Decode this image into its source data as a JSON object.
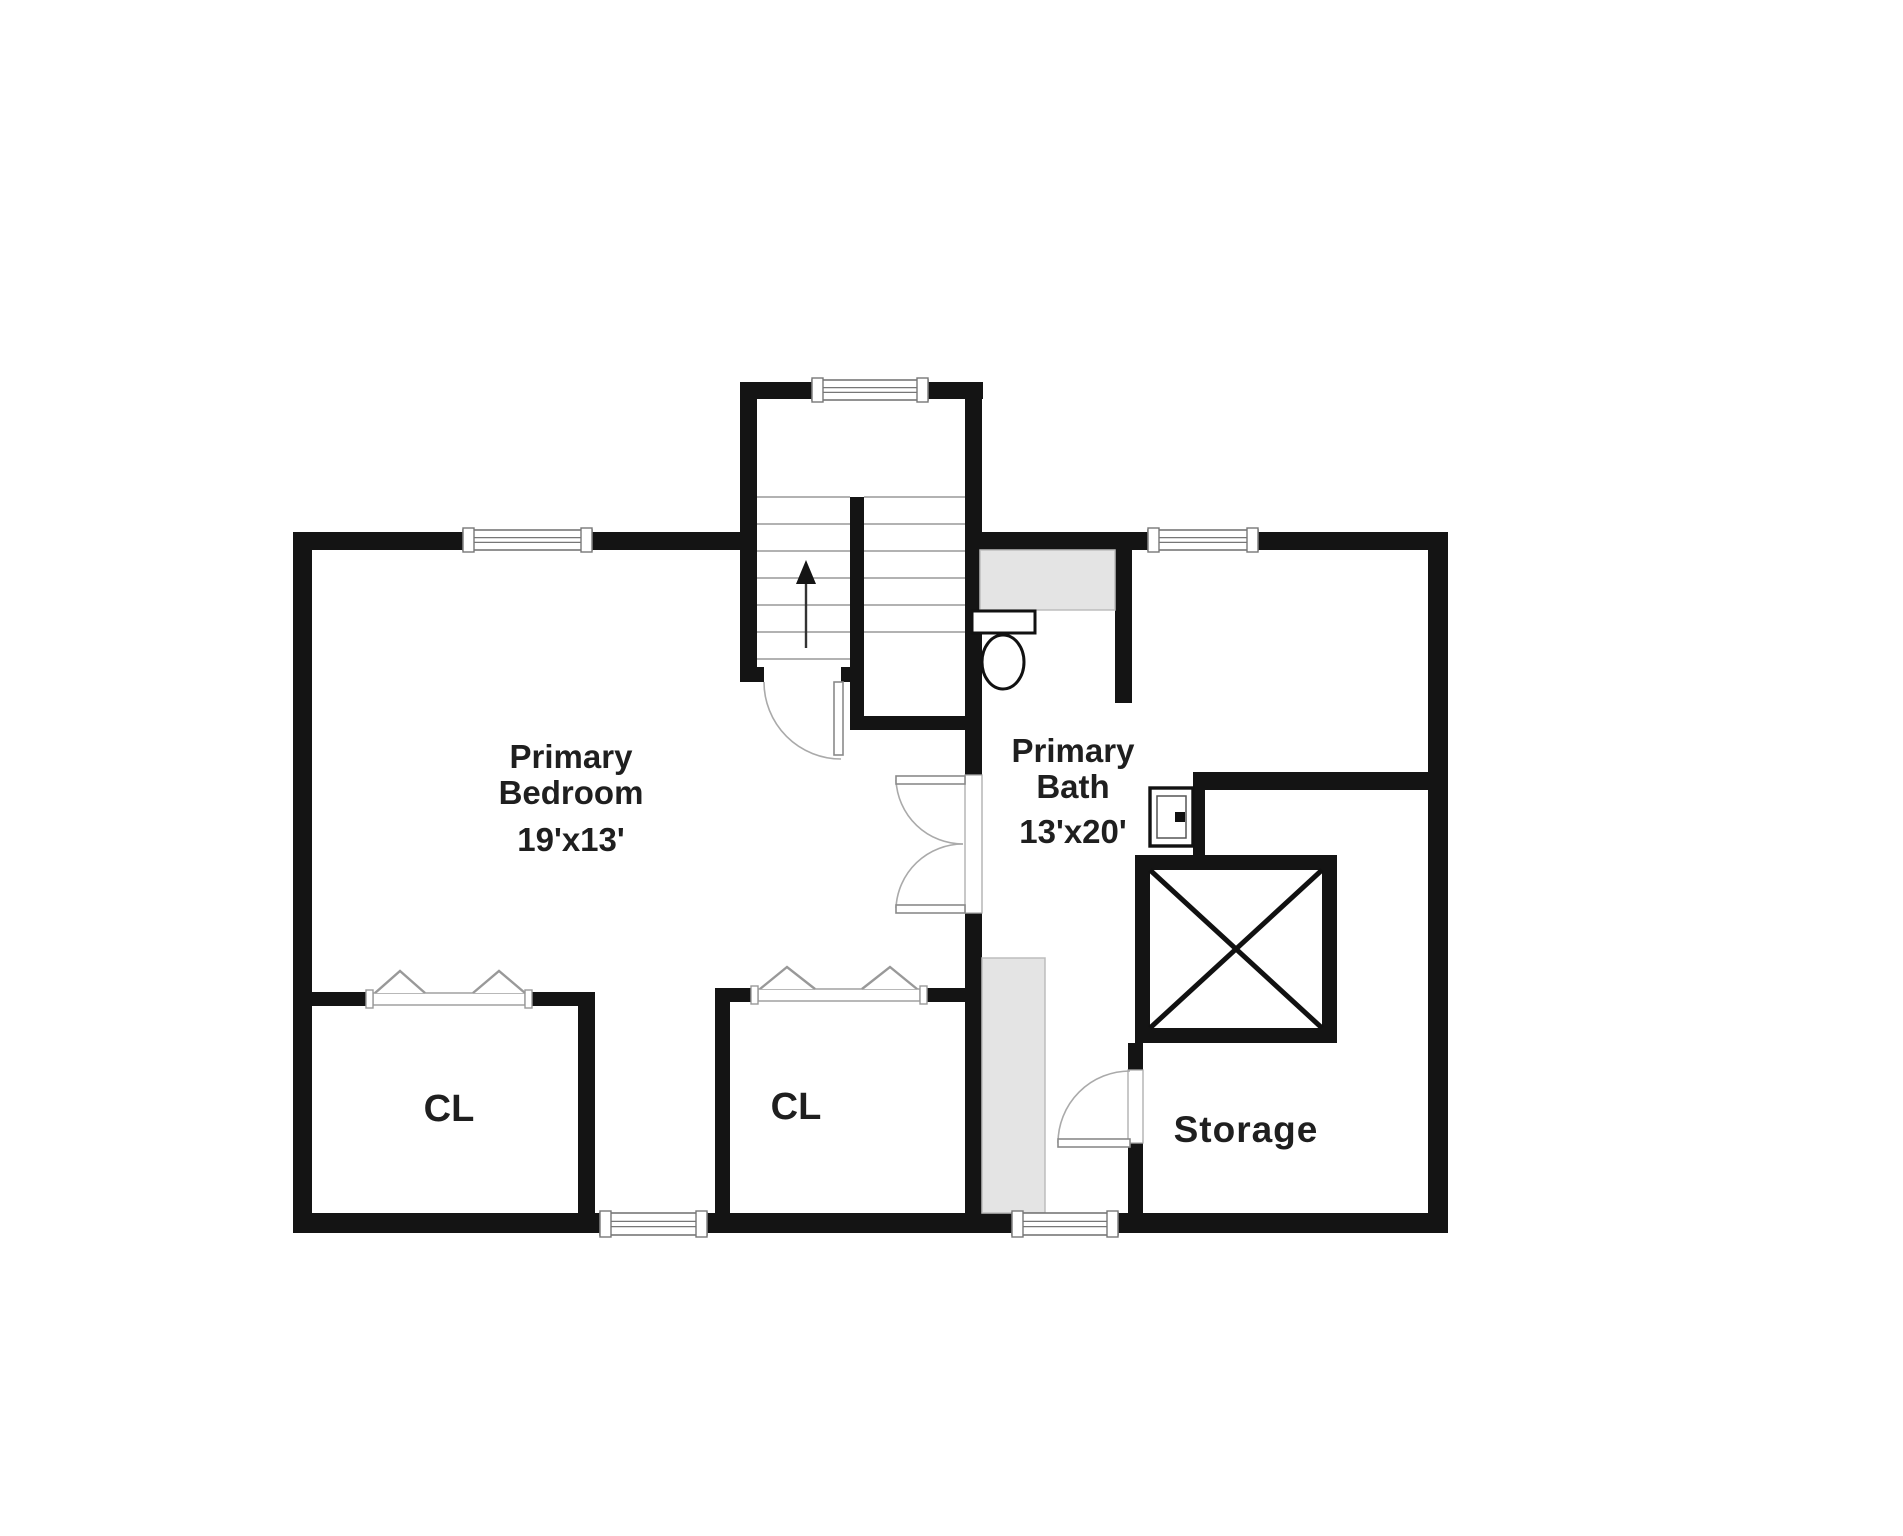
{
  "title": "Floor plan",
  "colors": {
    "wall": "#141414",
    "background": "#ffffff",
    "thin_line": "#999999",
    "door_line": "#aaaaaa",
    "gray_fill": "#e4e4e4",
    "gray_border": "#bdbdbd",
    "text": "#1f1f1f",
    "fixture_stroke": "#111111"
  },
  "canvas": {
    "width": 1903,
    "height": 1536
  },
  "labels": [
    {
      "name": "primary-bedroom-label",
      "x": 571,
      "y": 768,
      "size": 33,
      "spacing": 0,
      "lines": [
        {
          "t": "Primary",
          "dy": 0
        },
        {
          "t": "Bedroom",
          "dy": 36
        },
        {
          "t": "19'x13'",
          "dy": 83
        }
      ]
    },
    {
      "name": "primary-bath-label",
      "x": 1073,
      "y": 762,
      "size": 33,
      "spacing": 0,
      "lines": [
        {
          "t": "Primary",
          "dy": 0
        },
        {
          "t": "Bath",
          "dy": 36
        },
        {
          "t": "13'x20'",
          "dy": 81
        }
      ]
    },
    {
      "name": "closet-left-label",
      "x": 449,
      "y": 1121,
      "size": 38,
      "spacing": 0,
      "lines": [
        {
          "t": "CL",
          "dy": 0
        }
      ]
    },
    {
      "name": "closet-center-label",
      "x": 796,
      "y": 1119,
      "size": 38,
      "spacing": 0,
      "lines": [
        {
          "t": "CL",
          "dy": 0
        }
      ]
    },
    {
      "name": "storage-label",
      "x": 1246,
      "y": 1142,
      "size": 37,
      "spacing": 1,
      "lines": [
        {
          "t": "Storage",
          "dy": 0
        }
      ]
    }
  ],
  "walls": [
    {
      "name": "west-wall",
      "r": [
        293,
        532,
        19,
        701
      ]
    },
    {
      "name": "top-wall-bedroom-left",
      "r": [
        293,
        532,
        170,
        18
      ]
    },
    {
      "name": "top-wall-bedroom-right",
      "r": [
        592,
        532,
        148,
        18
      ]
    },
    {
      "name": "stairwell-left-wall",
      "r": [
        740,
        382,
        17,
        300
      ]
    },
    {
      "name": "stairwell-top-wall-left",
      "r": [
        740,
        382,
        72,
        17
      ]
    },
    {
      "name": "stairwell-top-wall-right",
      "r": [
        928,
        382,
        55,
        17
      ]
    },
    {
      "name": "bedroom-bath-wall-upper",
      "r": [
        965,
        382,
        17,
        393
      ]
    },
    {
      "name": "top-wall-bath-left",
      "r": [
        982,
        532,
        166,
        18
      ]
    },
    {
      "name": "top-wall-bath-right",
      "r": [
        1258,
        532,
        190,
        18
      ]
    },
    {
      "name": "east-wall",
      "r": [
        1428,
        532,
        20,
        701
      ]
    },
    {
      "name": "bottom-wall-left",
      "r": [
        293,
        1213,
        307,
        20
      ]
    },
    {
      "name": "bottom-wall-center",
      "r": [
        707,
        1213,
        305,
        20
      ]
    },
    {
      "name": "bottom-wall-right",
      "r": [
        1118,
        1213,
        330,
        20
      ]
    },
    {
      "name": "bedroom-bath-wall-lower",
      "r": [
        965,
        913,
        17,
        302
      ]
    },
    {
      "name": "stair-divider-wall",
      "r": [
        850,
        497,
        14,
        233
      ]
    },
    {
      "name": "hall-north-wall",
      "r": [
        850,
        716,
        132,
        14
      ]
    },
    {
      "name": "stair-door-stub-left",
      "r": [
        750,
        667,
        14,
        15
      ]
    },
    {
      "name": "stair-door-stub-right",
      "r": [
        841,
        667,
        14,
        15
      ]
    },
    {
      "name": "toilet-nook-wall",
      "r": [
        1115,
        550,
        17,
        153
      ]
    },
    {
      "name": "bath-east-wall",
      "r": [
        1193,
        772,
        255,
        18
      ]
    },
    {
      "name": "sink-wall",
      "r": [
        1193,
        790,
        12,
        68
      ]
    },
    {
      "name": "shower-wall-top",
      "r": [
        1135,
        855,
        202,
        15
      ]
    },
    {
      "name": "shower-wall-left",
      "r": [
        1135,
        855,
        15,
        188
      ]
    },
    {
      "name": "shower-wall-right",
      "r": [
        1322,
        855,
        15,
        188
      ]
    },
    {
      "name": "shower-wall-bottom",
      "r": [
        1135,
        1028,
        202,
        15
      ]
    },
    {
      "name": "storage-wall-stub",
      "r": [
        1128,
        1043,
        15,
        27
      ]
    },
    {
      "name": "storage-wall-lower",
      "r": [
        1128,
        1143,
        15,
        72
      ]
    },
    {
      "name": "closet-center-left-wall",
      "r": [
        715,
        988,
        15,
        227
      ]
    },
    {
      "name": "closet-center-top-left",
      "r": [
        715,
        988,
        37,
        14
      ]
    },
    {
      "name": "closet-center-top-right",
      "r": [
        926,
        988,
        39,
        14
      ]
    },
    {
      "name": "closet-left-right-wall",
      "r": [
        578,
        992,
        17,
        223
      ]
    },
    {
      "name": "closet-left-top-left",
      "r": [
        312,
        992,
        55,
        14
      ]
    },
    {
      "name": "closet-left-top-right",
      "r": [
        531,
        992,
        64,
        14
      ]
    }
  ],
  "gray_areas": [
    {
      "name": "bath-counter-top",
      "r": [
        980,
        550,
        135,
        60
      ]
    },
    {
      "name": "bath-vanity-counter",
      "r": [
        982,
        958,
        63,
        255
      ]
    }
  ],
  "windows": [
    {
      "name": "bedroom-window",
      "r": [
        463,
        530,
        129,
        20
      ]
    },
    {
      "name": "stairwell-window",
      "r": [
        812,
        380,
        116,
        20
      ]
    },
    {
      "name": "bath-window",
      "r": [
        1148,
        530,
        110,
        20
      ]
    },
    {
      "name": "bottom-window-left",
      "r": [
        600,
        1213,
        107,
        22
      ]
    },
    {
      "name": "bottom-window-right",
      "r": [
        1012,
        1213,
        106,
        22
      ]
    }
  ],
  "closets": [
    {
      "name": "closet-left-opening",
      "band": [
        373,
        993,
        152,
        12
      ],
      "caps": [
        [
          366,
          990,
          7,
          18
        ],
        [
          525,
          990,
          7,
          18
        ]
      ],
      "triangles": [
        [
          375,
          993,
          400,
          971,
          425,
          993
        ],
        [
          473,
          993,
          499,
          971,
          525,
          993
        ]
      ]
    },
    {
      "name": "closet-center-opening",
      "band": [
        758,
        989,
        162,
        12
      ],
      "caps": [
        [
          751,
          986,
          7,
          18
        ],
        [
          920,
          986,
          7,
          18
        ]
      ],
      "triangles": [
        [
          760,
          989,
          787,
          967,
          815,
          989
        ],
        [
          862,
          989,
          890,
          967,
          917,
          989
        ]
      ]
    }
  ],
  "stairs": {
    "name": "staircase",
    "treads_left": {
      "x1": 757,
      "x2": 850,
      "ys": [
        497,
        524,
        551,
        578,
        605,
        632,
        659
      ]
    },
    "treads_right": {
      "x1": 864,
      "x2": 965,
      "ys": [
        497,
        524,
        551,
        578,
        605,
        632
      ]
    },
    "arrow": {
      "shaft": [
        806,
        648,
        806,
        582
      ],
      "head": [
        [
          806,
          560
        ],
        [
          796,
          584
        ],
        [
          816,
          584
        ]
      ]
    }
  },
  "doors": [
    {
      "name": "stair-door",
      "frame": null,
      "leaf": [
        834,
        682,
        9,
        73
      ],
      "arc": "M 764 682 A 77 77 0 0 0 841 759"
    },
    {
      "name": "bath-double-door",
      "frame": [
        965,
        775,
        17,
        138
      ],
      "leaf": [
        896,
        776,
        69,
        8
      ],
      "arc": "M 896 780 A 67 67 0 0 0 963 844",
      "leaf2": [
        896,
        905,
        69,
        8
      ],
      "arc2": "M 896 908 A 67 67 0 0 1 963 844"
    },
    {
      "name": "storage-door",
      "frame": [
        1128,
        1070,
        15,
        73
      ],
      "leaf": [
        1058,
        1139,
        72,
        8
      ],
      "arc": "M 1058 1143 A 72 72 0 0 1 1130 1071"
    }
  ],
  "fixtures": {
    "toilet": {
      "name": "toilet",
      "tank": [
        972,
        611,
        63,
        22
      ],
      "bowl": {
        "cx": 1003,
        "cy": 662,
        "rx": 21,
        "ry": 27
      }
    },
    "sink": {
      "name": "sink",
      "outer": [
        1150,
        788,
        43,
        58
      ],
      "inner": [
        1157,
        796,
        29,
        42
      ],
      "faucet": [
        1175,
        812,
        10,
        10
      ]
    },
    "shower": {
      "name": "shower",
      "x1": 1150,
      "y1": 870,
      "x2": 1322,
      "y2": 1028
    }
  }
}
